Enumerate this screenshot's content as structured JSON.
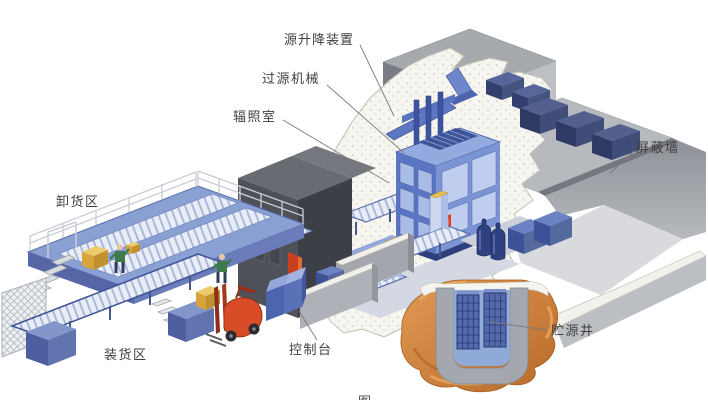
{
  "diagram": {
    "labels": {
      "source_hoist": "源升降装置",
      "source_transfer_machine": "过源机械",
      "irradiation_room": "辐照室",
      "shield_wall": "屏蔽墙",
      "unloading_area": "卸货区",
      "loading_area": "装货区",
      "control_console": "控制台",
      "source_storage_well": "贮源井",
      "caption_partial": "图"
    },
    "colors": {
      "machine_blue": "#5a75c2",
      "panel_blue": "#b0c1ea",
      "dark_cargo_blue": "#3a4a7c",
      "platform_blue": "#89a0d2",
      "concrete_gray": "#b6b9bd",
      "annex_dark_gray": "#4e5157",
      "cutaway_white": "#f7f5f0",
      "earth_orange": "#c97c35",
      "pool_blue": "#8fa9d8",
      "cargo_yellow": "#e8c050",
      "forklift_red": "#d84c27"
    }
  }
}
